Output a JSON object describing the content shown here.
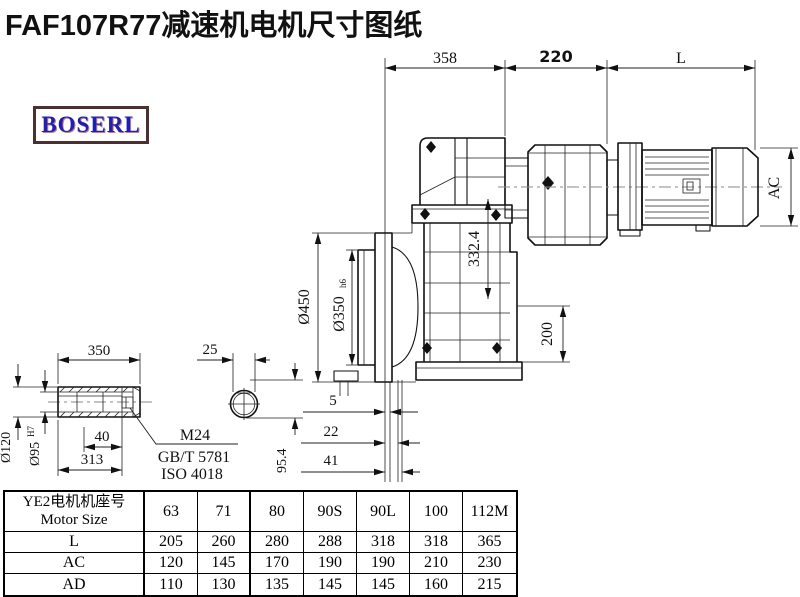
{
  "title": "FAF107R77减速机电机尺寸图纸",
  "logo": "BOSERL",
  "dims": {
    "gearbox_length": "358",
    "adapter_length": "220",
    "motor_length": "L",
    "motor_diameter": "AC",
    "flange_diameter": "Ø450",
    "spigot_diameter": "Ø350",
    "spigot_fit": "h6",
    "center_height": "332.4",
    "foot_height": "200",
    "offset_1": "5",
    "offset_2": "22",
    "offset_3": "41",
    "shaft_length": "350",
    "key_width": "25",
    "thread_depth": "40",
    "bore_length": "313",
    "shaft_outer_diameter": "Ø120",
    "bore_diameter": "Ø95",
    "bore_fit": "H7",
    "keyway_height": "95.4",
    "thread_spec": "M24",
    "standard_1": "GB/T 5781",
    "standard_2": "ISO 4018"
  },
  "table": {
    "header_cn": "YE2电机机座号",
    "header_en": "Motor Size",
    "columns": [
      "63",
      "71",
      "80",
      "90S",
      "90L",
      "100",
      "112M"
    ],
    "rows": [
      {
        "label": "L",
        "values": [
          "205",
          "260",
          "280",
          "288",
          "318",
          "318",
          "365"
        ]
      },
      {
        "label": "AC",
        "values": [
          "120",
          "145",
          "170",
          "190",
          "190",
          "210",
          "230"
        ]
      },
      {
        "label": "AD",
        "values": [
          "110",
          "130",
          "135",
          "145",
          "145",
          "160",
          "215"
        ]
      }
    ]
  }
}
